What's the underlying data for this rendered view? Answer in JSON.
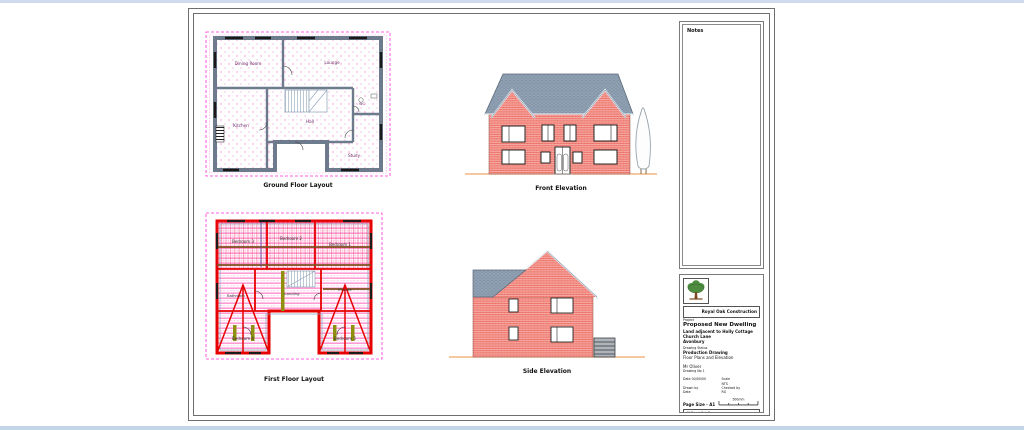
{
  "page": {
    "top_strip_color": "#cfdcee",
    "bottom_strip_color": "#c6d6ea"
  },
  "ground_floor": {
    "caption": "Ground Floor Layout",
    "rooms": {
      "dining": "Dining Room",
      "lounge": "Lounge",
      "kitchen": "Kitchen",
      "hall": "Hall",
      "study": "Study",
      "wc": "WC"
    }
  },
  "first_floor": {
    "caption": "First Floor Layout",
    "rooms": {
      "bed3": "Bedroom 3",
      "bed2": "Bedroom 2",
      "bed1": "Bedroom 1",
      "bathroom": "Bathroom",
      "landing": "Landing",
      "ensuite": "Ensuite",
      "bed4": "Bedroom 4",
      "bed5": "Bedroom 5"
    }
  },
  "front_elevation": {
    "caption": "Front Elevation"
  },
  "side_elevation": {
    "caption": "Side Elevation"
  },
  "notes": {
    "title": "Notes"
  },
  "title_block": {
    "company": "Royal Oak Construction",
    "project_label": "Project",
    "project_name": "Proposed New Dwelling",
    "site_lines": [
      "Land adjacent to Holly Cottage",
      "Church Lane",
      "Avonbury"
    ],
    "status_line": "Drawing Status",
    "drawing_type": "Production Drawing",
    "drawing_title": "Floor Plans and Elevation",
    "client": "Mr Oliver",
    "drawing_no": "Drawing No 1",
    "fields": [
      [
        "Date 00/00/00",
        "Scale"
      ],
      [
        "",
        "NTS"
      ],
      [
        "Drawn by",
        "Checked by"
      ],
      [
        "Date",
        "RG"
      ]
    ],
    "page_size": "Page Size - A1",
    "scale_bar_label": "500mm",
    "footer_lines": [
      "40 Burnt Oak Barn",
      "Oakley, Staffordshire",
      "01782 Royal Oak Construction"
    ]
  },
  "colors": {
    "plan_magenta": "#ff2bdd",
    "plan_red": "#e60000",
    "wall_gray": "#6d7b8c",
    "brick_red": "#ec6a5f",
    "roof_gray": "#8fa0b3",
    "ground_orange": "#f0a868",
    "beam_brown": "#7d4e1e",
    "logo_green": "#4e8c3f"
  }
}
